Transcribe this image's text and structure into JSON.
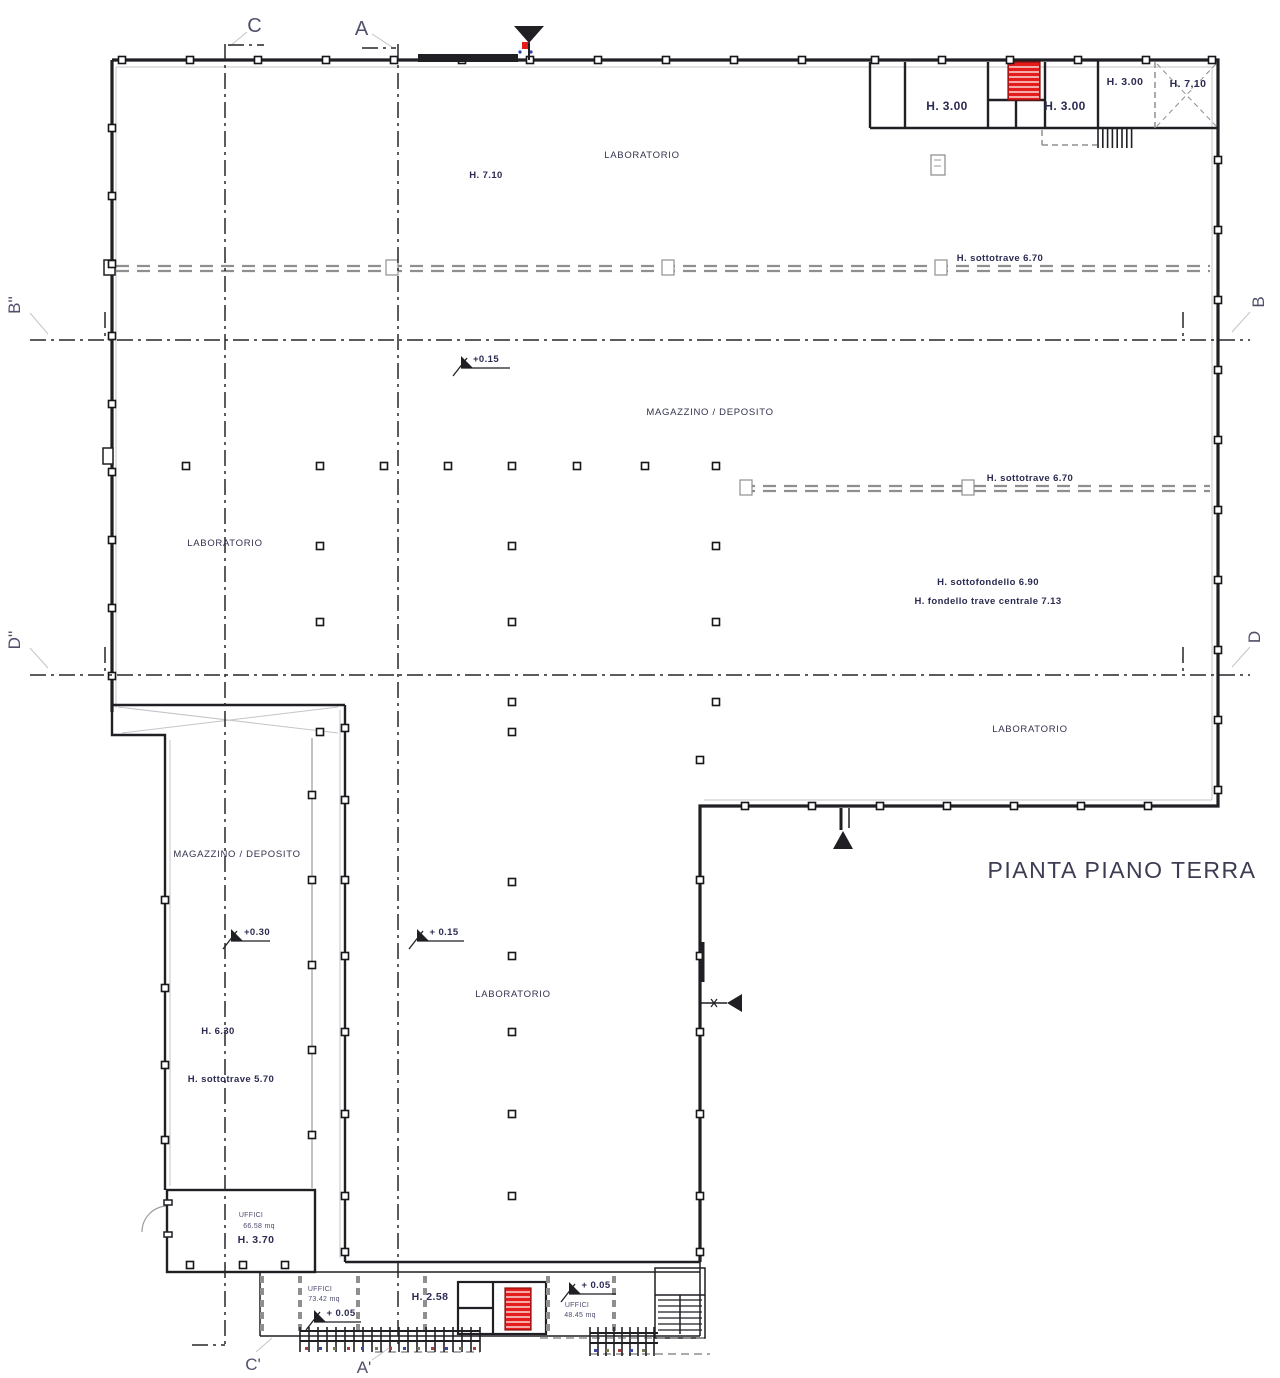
{
  "title": {
    "text": "PIANTA PIANO TERRA"
  },
  "section_markers": {
    "c_top": "C",
    "a_top": "A",
    "c_bottom": "C'",
    "a_bottom": "A'",
    "b_left": "B''",
    "b_right": "B",
    "d_left": "D''",
    "d_right": "D"
  },
  "rooms": {
    "laboratorio_top": "LABORATORIO",
    "magazzino_center": "MAGAZZINO / DEPOSITO",
    "laboratorio_left": "LABORATORIO",
    "laboratorio_right": "LABORATORIO",
    "magazzino_wing": "MAGAZZINO / DEPOSITO",
    "laboratorio_lower": "LABORATORIO",
    "uffici_room": "UFFICI",
    "uffici_left": "UFFICI",
    "uffici_right": "UFFICI"
  },
  "heights": {
    "h710_top": "H. 7.10",
    "sottotrave_670_upper": "H. sottotrave 6.70",
    "sottotrave_670_lower": "H. sottotrave 6.70",
    "sottofondello_690": "H. sottofondello 6.90",
    "fondello_trave_713": "H. fondello trave centrale 7.13",
    "h630_wing": "H. 6.30",
    "sottotrave_570_wing": "H. sottotrave 5.70",
    "h370_office": "H. 3.70",
    "h258_strip": "H. 2.58",
    "room1_h300": "H. 3.00",
    "room2_h300": "H. 3.00",
    "room3_h300": "H. 3.00",
    "room4_h710": "H. 7,10"
  },
  "levels": {
    "l015_upper": "+0.15",
    "l030_wing": "+0.30",
    "l015_lower": "+ 0.15",
    "l005_left": "+ 0.05",
    "l005_right": "+ 0.05"
  },
  "areas": {
    "office_main": "66.58 mq",
    "office_left": "73.42 mq",
    "office_right": "48.45 mq"
  },
  "colors": {
    "stair_red": "#e41c1c",
    "ink": "#1f1f24",
    "muted_gray": "#8f8f8f",
    "text_navy": "#32324e"
  }
}
